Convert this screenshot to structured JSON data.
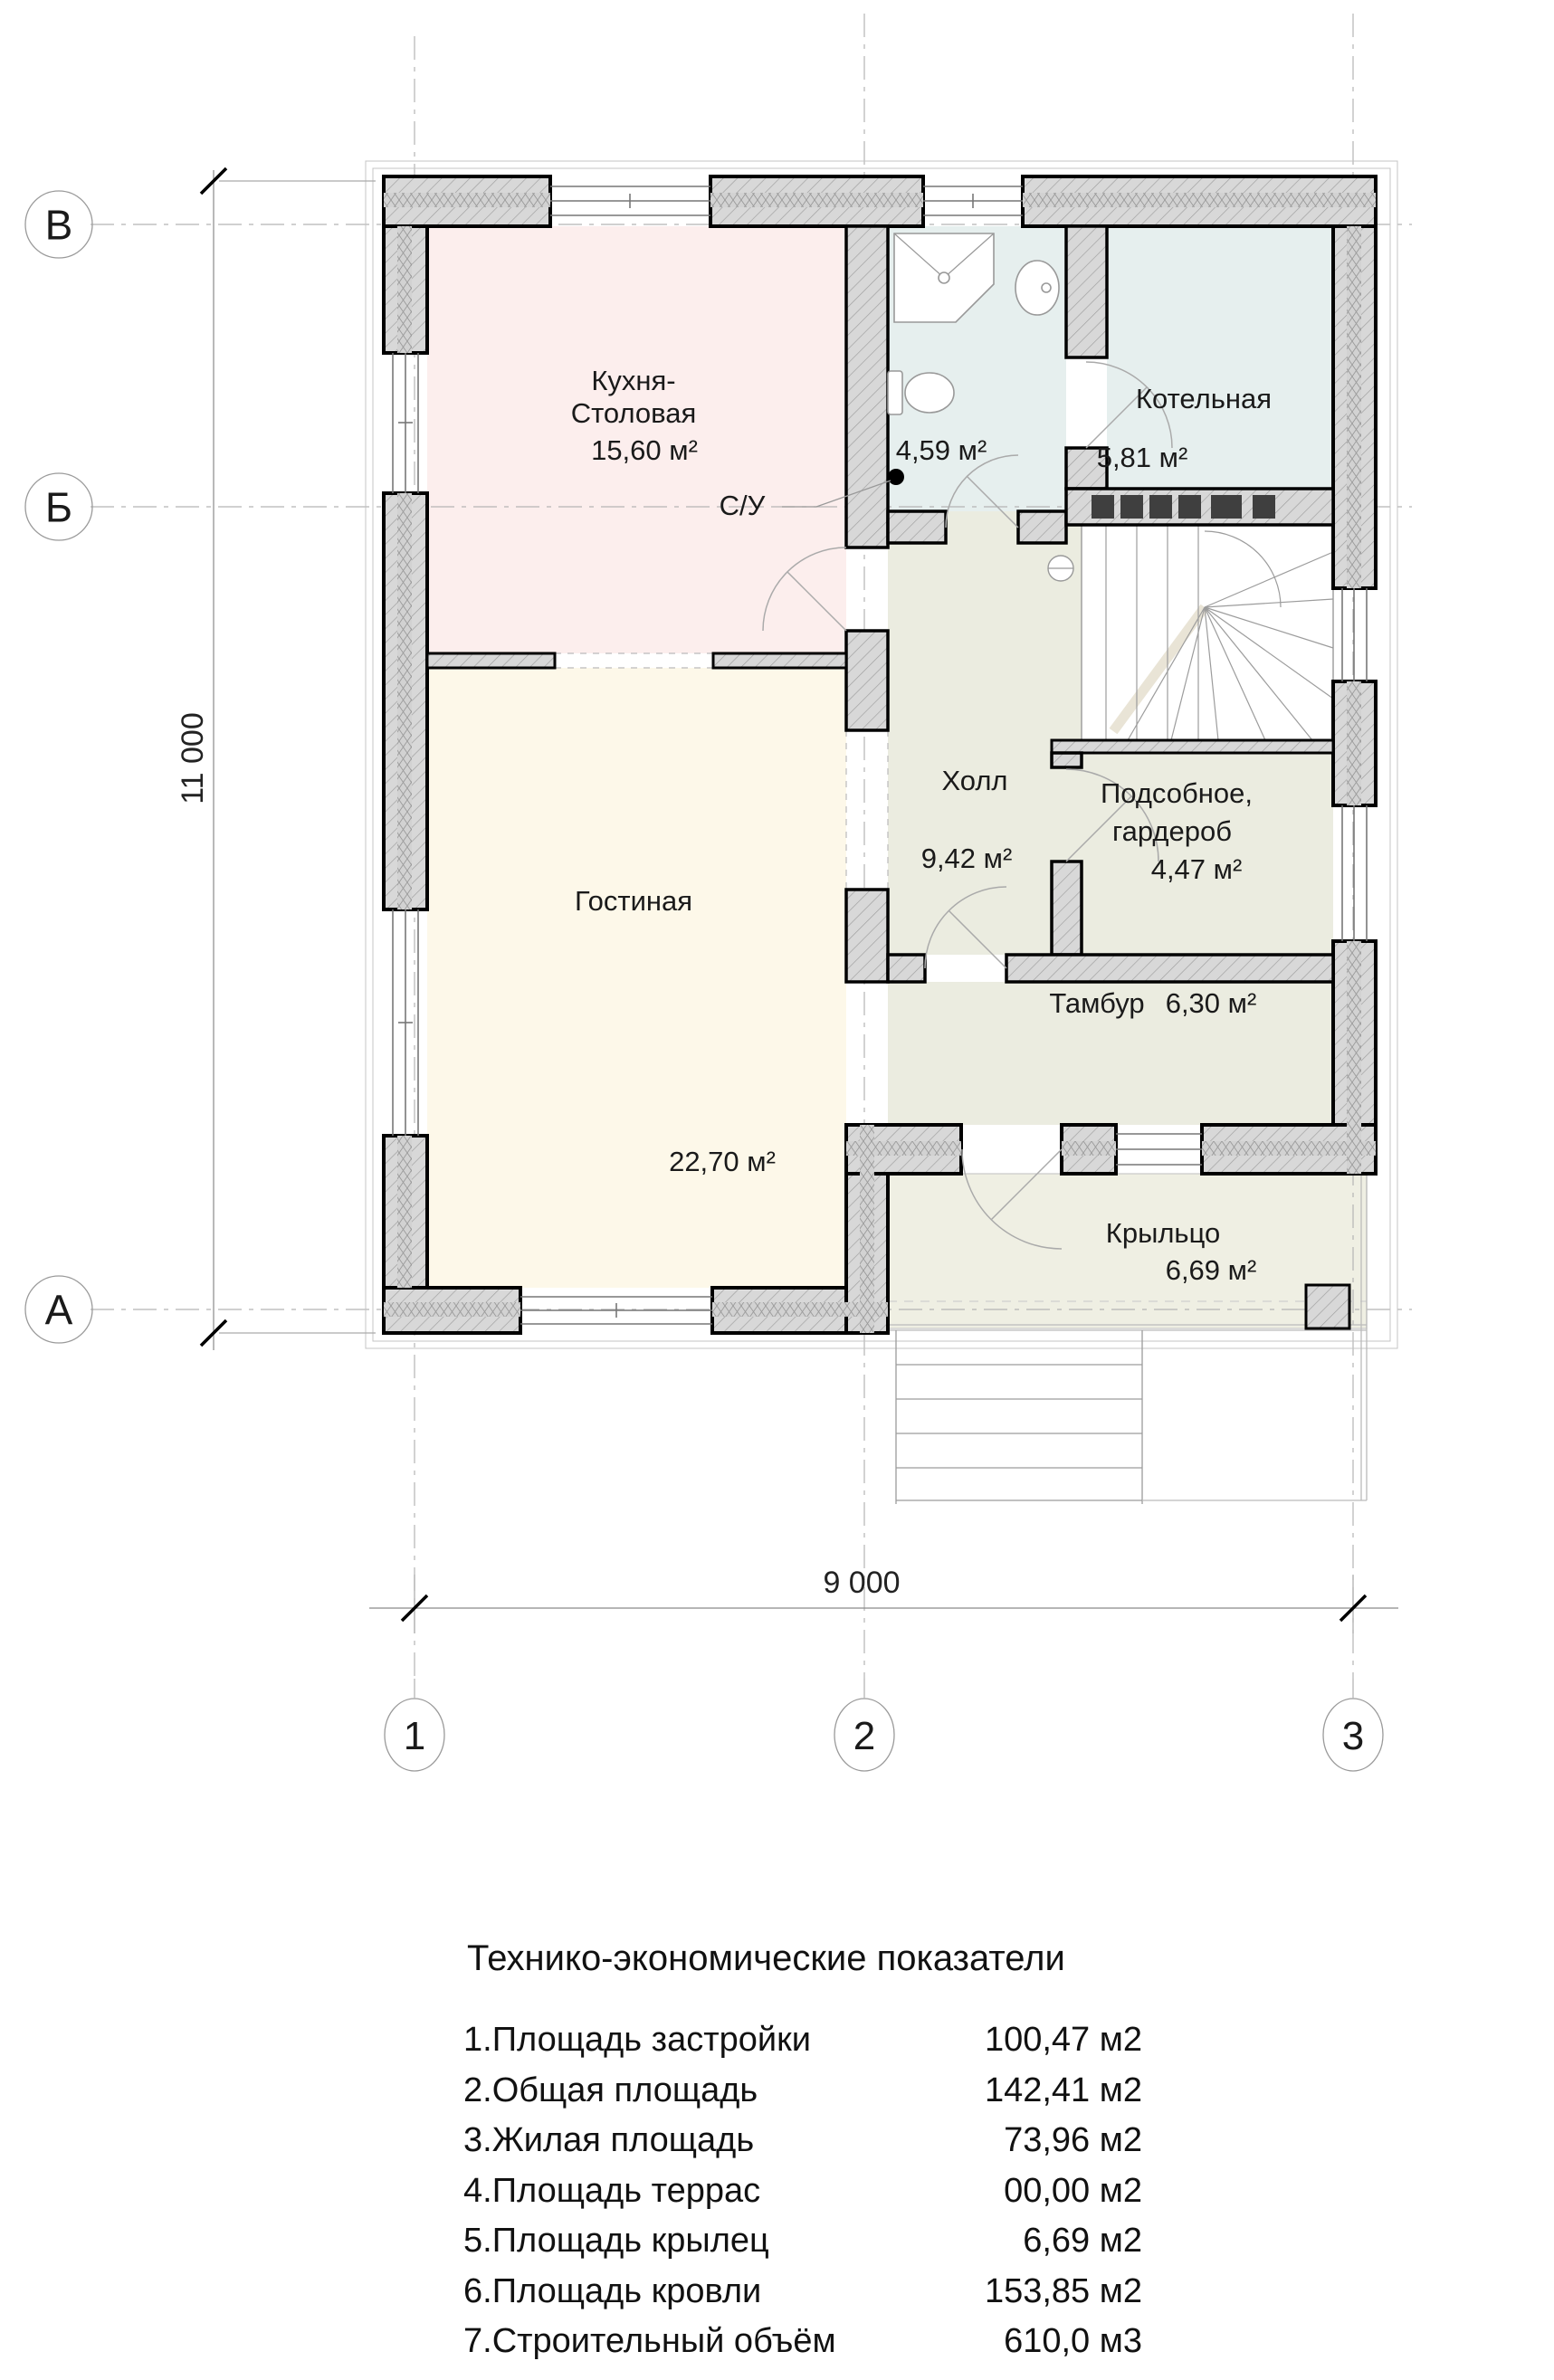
{
  "plan": {
    "axis_letters": [
      "В",
      "Б",
      "А"
    ],
    "axis_numbers": [
      "1",
      "2",
      "3"
    ],
    "dim_height": "11 000",
    "dim_width": "9 000",
    "rooms": [
      {
        "id": "kitchen",
        "line1": "Кухня-",
        "line2": "Столовая",
        "area": "15,60 м²"
      },
      {
        "id": "wc",
        "name": "С/У",
        "area": "4,59 м²"
      },
      {
        "id": "boiler",
        "name": "Котельная",
        "area": "5,81 м²"
      },
      {
        "id": "hall",
        "name": "Холл",
        "area": "9,42 м²"
      },
      {
        "id": "pantry",
        "line1": "Подсобное,",
        "line2": "гардероб",
        "area": "4,47 м²"
      },
      {
        "id": "living",
        "name": "Гостиная",
        "area": "22,70 м²"
      },
      {
        "id": "tambour",
        "name": "Тамбур",
        "area": "6,30 м²"
      },
      {
        "id": "porch",
        "name": "Крыльцо",
        "area": "6,69 м²"
      }
    ],
    "colors": {
      "kitchen": "#fceeed",
      "living": "#fdf8e9",
      "wet_rooms": "#e6efee",
      "hall_rooms": "#ebece0",
      "porch": "#efefe3",
      "wall_fill": "#d8d8d8"
    }
  },
  "table": {
    "title": "Технико-экономические показатели",
    "rows": [
      {
        "label": "1.Площадь застройки",
        "value": "100,47 м2"
      },
      {
        "label": "2.Общая площадь",
        "value": "142,41 м2"
      },
      {
        "label": "3.Жилая площадь",
        "value": "73,96 м2"
      },
      {
        "label": "4.Площадь террас",
        "value": "00,00 м2"
      },
      {
        "label": "5.Площадь крылец",
        "value": "6,69 м2"
      },
      {
        "label": "6.Площадь кровли",
        "value": "153,85 м2"
      },
      {
        "label": "7.Строительный объём",
        "value": "610,0 м3"
      }
    ]
  }
}
